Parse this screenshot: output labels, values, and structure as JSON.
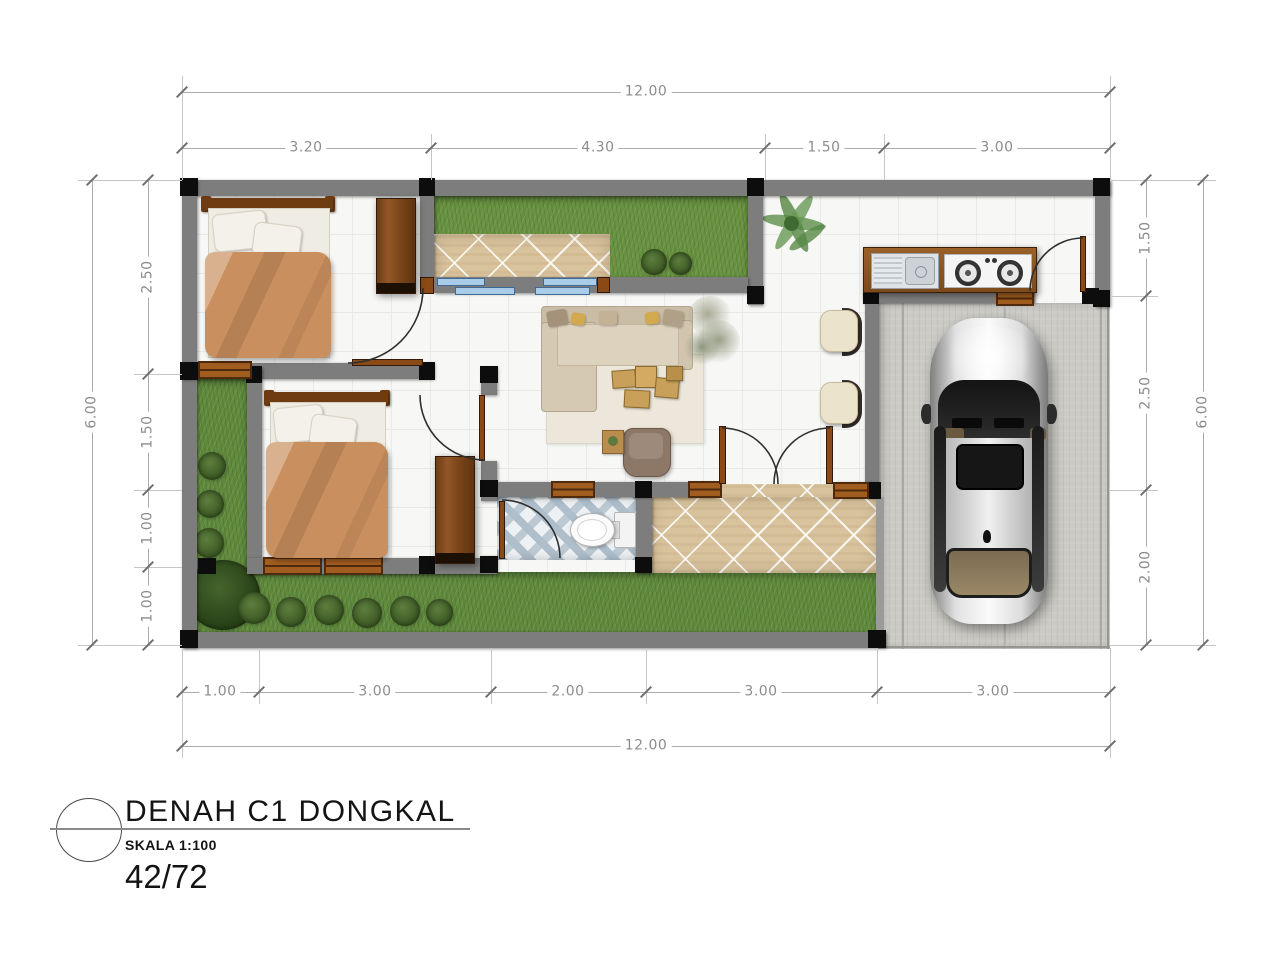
{
  "title_block": {
    "drawing_title": "DENAH C1 DONGKAL",
    "scale_label": "SKALA 1:100",
    "type_label": "42/72"
  },
  "dimensions": {
    "top": {
      "overall": "12.00",
      "segments": [
        "3.20",
        "4.30",
        "1.50",
        "3.00"
      ]
    },
    "bottom": {
      "overall": "12.00",
      "segments": [
        "1.00",
        "3.00",
        "2.00",
        "3.00",
        "3.00"
      ]
    },
    "left": {
      "overall": "6.00",
      "segments": [
        "2.50",
        "1.50",
        "1.00",
        "1.00"
      ]
    },
    "right": {
      "overall": "6.00",
      "segments": [
        "1.50",
        "2.50",
        "2.00"
      ]
    }
  },
  "colors": {
    "wall": "#7d7d7d",
    "column": "#0d0d0d",
    "grass": "#5f8a3c",
    "wood": "#8a4a16",
    "terrace_tile": "#d9c39d",
    "bathroom_tile": "#aebecb",
    "window_blue": "#a9cde9",
    "concrete": "#cbcac5",
    "blanket": "#c98f5e",
    "dimension_text": "#8c8c8c"
  }
}
